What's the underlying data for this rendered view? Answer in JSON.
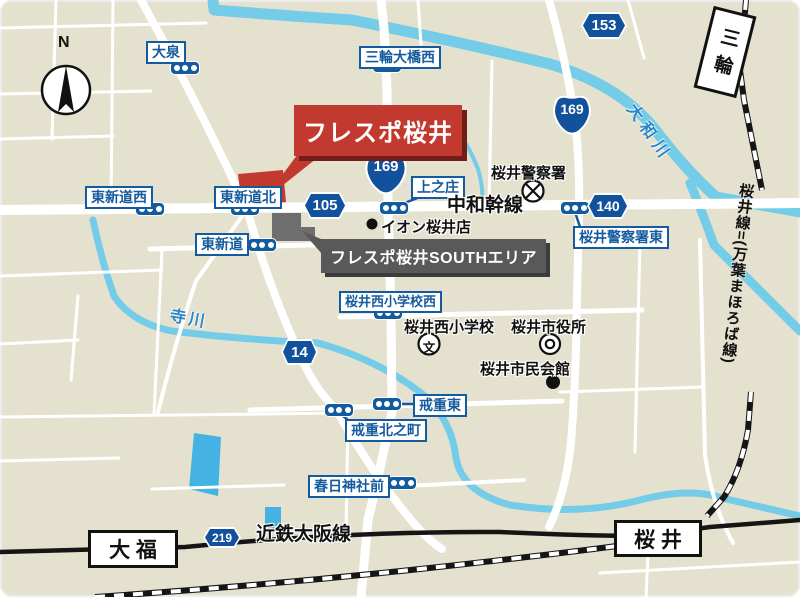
{
  "map": {
    "compass": "N",
    "banner": "フレスポ桜井",
    "south_banner": "フレスポ桜井SOUTHエリア",
    "trunk_road": "中和幹線",
    "intersections": {
      "oizumi": "大泉",
      "miwa_ohashi_nishi": "三輪大橋西",
      "higashi_shindo_nishi": "東新道西",
      "higashi_shindo_kita": "東新道北",
      "kaminosho": "上之庄",
      "higashi_shindo": "東新道",
      "sakurai_nishi_shogakko_nishi": "桜井西小学校西",
      "kaiju_higashi": "戒重東",
      "kaiju_kitanocho": "戒重北之町",
      "kasuga_jinja_mae": "春日神社前",
      "sakurai_keisatsusho_higashi": "桜井警察署東"
    },
    "shields": {
      "n169a": "169",
      "n169b": "169",
      "p153": "153",
      "p105": "105",
      "p140": "140",
      "p14": "14",
      "p219": "219"
    },
    "pois": {
      "aeon": "イオン桜井店",
      "police": "桜井警察署",
      "elementary": "桜井西小学校",
      "school_symbol": "文",
      "city_hall": "桜井市役所",
      "civic_hall": "桜井市民会館"
    },
    "waters": {
      "yamato_river": "大和川",
      "tera_river": "寺川"
    },
    "railways": {
      "kintetsu": "近鉄大阪線",
      "sakurai_line": "桜井線=(万葉まほろば線)"
    },
    "stations": {
      "miwa": "三輪",
      "daifuku": "大 福",
      "sakurai": "桜 井"
    },
    "colors": {
      "background": "#e4e1cf",
      "road": "#ffffff",
      "water": "#74cce8",
      "sign_blue": "#145a9e",
      "shield_blue": "#12519b",
      "banner_red": "#c23a2f",
      "banner_red_shadow": "#6f1f18",
      "banner_gray": "#595959",
      "building_gray": "#6e6e6e",
      "rail_black": "#151515"
    }
  }
}
